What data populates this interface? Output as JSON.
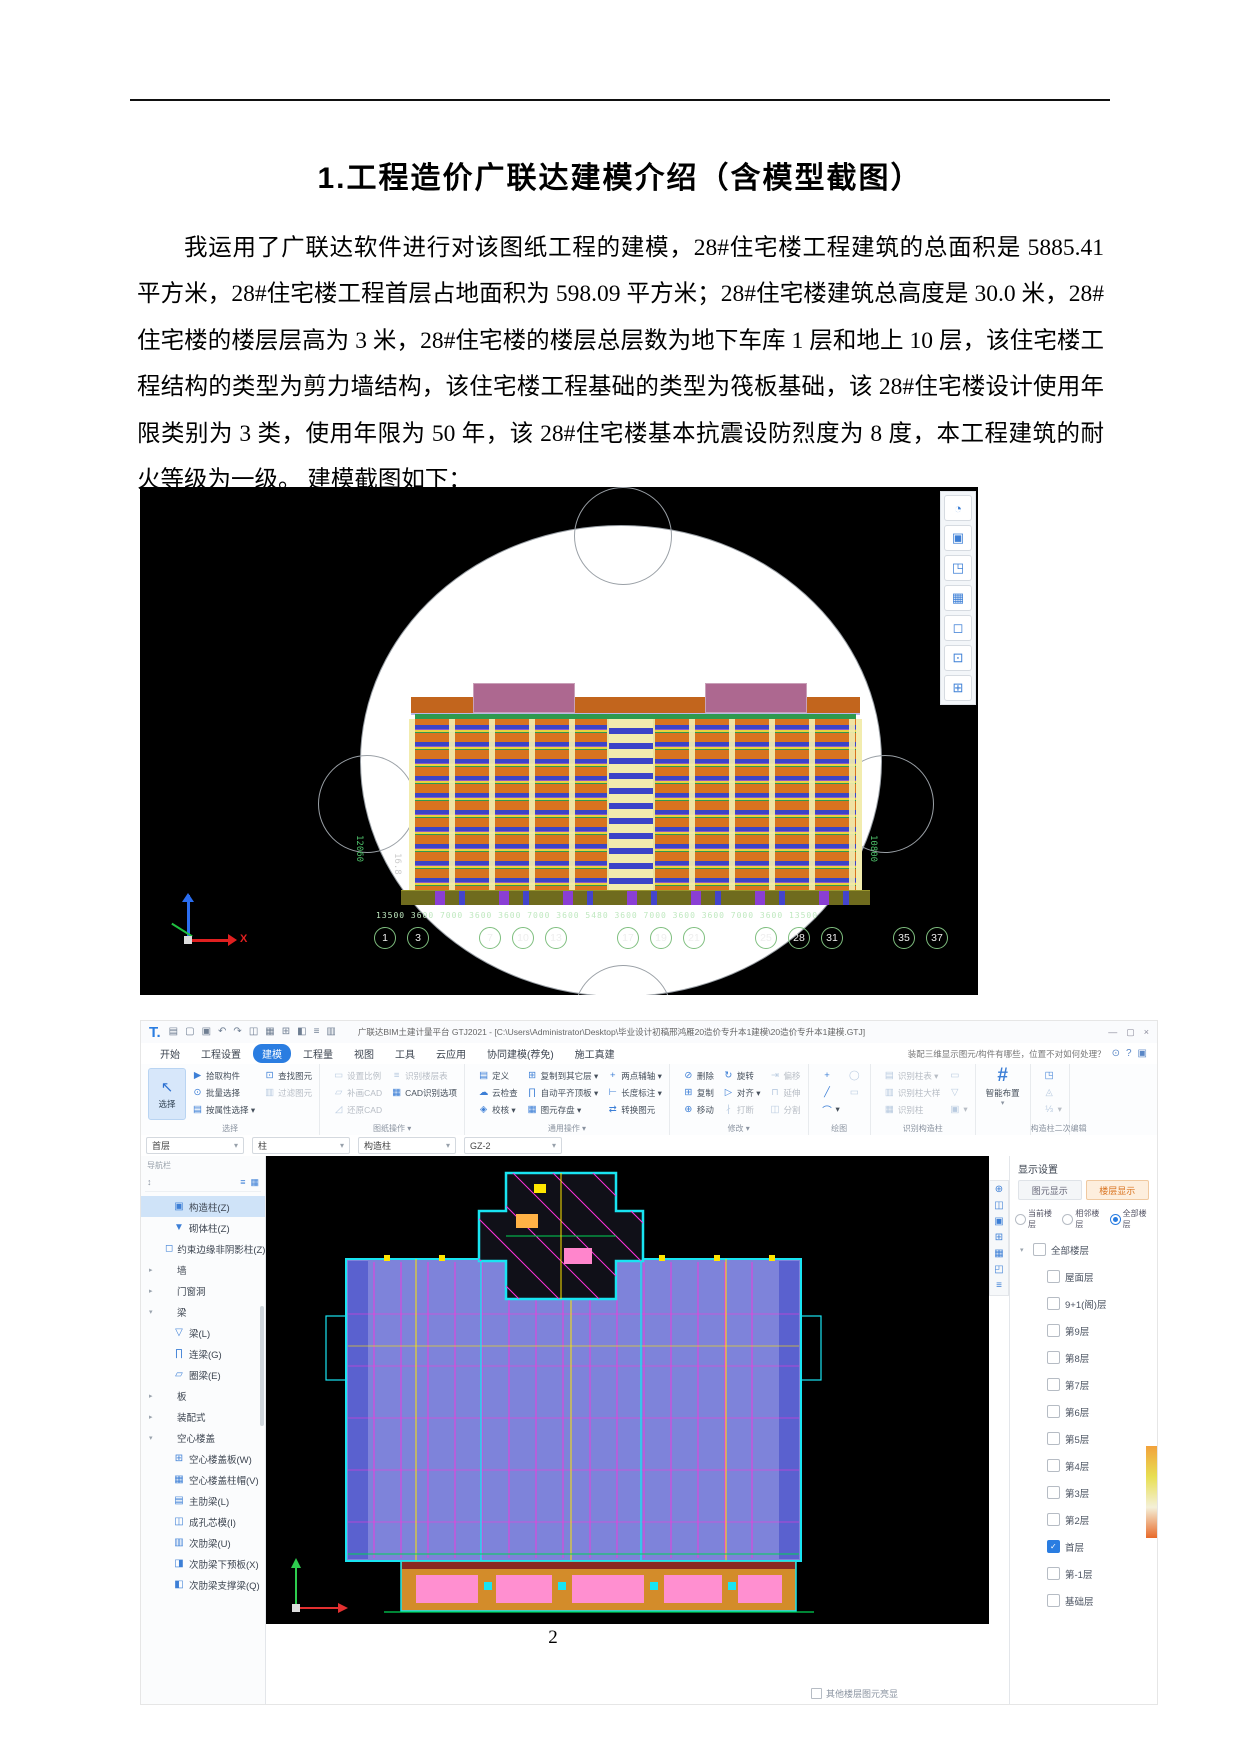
{
  "page": {
    "number": "2"
  },
  "doc": {
    "title": "1.工程造价广联达建模介绍（含模型截图）",
    "paragraph": "我运用了广联达软件进行对该图纸工程的建模，28#住宅楼工程建筑的总面积是 5885.41 平方米，28#住宅楼工程首层占地面积为 598.09 平方米；28#住宅楼建筑总高度是 30.0 米，28#住宅楼的楼层层高为 3 米，28#住宅楼的楼层总层数为地下车库 1 层和地上 10 层，该住宅楼工程结构的类型为剪力墙结构，该住宅楼工程基础的类型为筏板基础，该 28#住宅楼设计使用年限类别为 3 类，使用年限为 50 年，该 28#住宅楼基本抗震设防烈度为 8 度，本工程建筑的耐火等级为一级。 建模截图如下："
  },
  "model3d": {
    "dim_string": "13500 3600 7000 3600 3600 7000 3600 5480 3600 7000 3600 3600 7000 3600 13500",
    "left_dim": "12060",
    "left_dim2": "16.8",
    "right_dim": "10800",
    "axis_x": "X",
    "bubbles": [
      {
        "label": "1"
      },
      {
        "label": "3"
      },
      {
        "cls": "sp"
      },
      {
        "label": "7"
      },
      {
        "label": "10"
      },
      {
        "label": "13"
      },
      {
        "cls": "sp"
      },
      {
        "label": "17"
      },
      {
        "label": "19"
      },
      {
        "label": "21"
      },
      {
        "cls": "sp"
      },
      {
        "label": "25"
      },
      {
        "label": "28"
      },
      {
        "label": "31"
      },
      {
        "cls": "sp"
      },
      {
        "label": "35"
      },
      {
        "label": "37"
      }
    ],
    "tools": [
      {
        "g": "◔"
      },
      {
        "g": "▣"
      },
      {
        "g": "◳"
      },
      {
        "g": "▦"
      },
      {
        "g": "◻"
      },
      {
        "g": "⊡"
      },
      {
        "g": "⊞"
      }
    ]
  },
  "app": {
    "titlebar": {
      "logo": "T.",
      "quick_icons": [
        {
          "g": "▤"
        },
        {
          "g": "▢"
        },
        {
          "g": "▣"
        },
        {
          "g": "↶"
        },
        {
          "g": "↷"
        },
        {
          "g": "◫"
        },
        {
          "g": "▦"
        },
        {
          "g": "⊞"
        },
        {
          "g": "◧"
        },
        {
          "g": "≡"
        },
        {
          "g": "▥"
        }
      ],
      "title": "广联达BIM土建计量平台 GTJ2021 - [C:\\Users\\Administrator\\Desktop\\毕业设计初稿邢鸿雁20造价专升本1建模\\20造价专升本1建模.GTJ]",
      "window_controls": [
        {
          "g": "—"
        },
        {
          "g": "▢"
        },
        {
          "g": "×"
        }
      ]
    },
    "menubar": {
      "menus": [
        {
          "label": "开始"
        },
        {
          "label": "工程设置"
        },
        {
          "label": "建模",
          "cls": "active"
        },
        {
          "label": "工程量"
        },
        {
          "label": "视图"
        },
        {
          "label": "工具"
        },
        {
          "label": "云应用"
        },
        {
          "label": "协同建模(荐免)"
        },
        {
          "label": "施工真建"
        }
      ],
      "helper": "装配三维显示图元/构件有哪些，位置不对如何处理？",
      "helper_icons": [
        {
          "g": "⊙"
        },
        {
          "g": "?"
        },
        {
          "g": "▣"
        }
      ]
    },
    "ribbon": {
      "select_big": {
        "icon": "↖",
        "label": "选择"
      },
      "g1": {
        "label": "选择",
        "items": [
          {
            "ic": "▶",
            "label": "拾取构件"
          },
          {
            "ic": "⊡",
            "label": "查找图元"
          },
          {
            "ic": "⊙",
            "label": "批量选择"
          },
          {
            "ic": "▥",
            "label": "过滤图元",
            "cls": "gray"
          },
          {
            "ic": "▤",
            "label": "按属性选择 ▾"
          },
          {
            "label": "",
            "cls": "blank"
          }
        ]
      },
      "g2": {
        "label": "图纸操作 ▾",
        "items": [
          {
            "ic": "▭",
            "label": "设置比例",
            "cls": "gray"
          },
          {
            "ic": "≡",
            "label": "识别楼层表",
            "cls": "gray"
          },
          {
            "ic": "▱",
            "label": "补画CAD",
            "cls": "gray"
          },
          {
            "ic": "▦",
            "label": "CAD识别选项"
          },
          {
            "ic": "◿",
            "label": "还原CAD",
            "cls": "gray"
          },
          {
            "label": "",
            "cls": "blank"
          }
        ]
      },
      "g3": {
        "label": "通用操作 ▾",
        "items": [
          {
            "ic": "▤",
            "label": "定义"
          },
          {
            "ic": "⊞",
            "label": "复制到其它层 ▾"
          },
          {
            "ic": "+",
            "label": "两点辅轴 ▾"
          },
          {
            "ic": "☁",
            "label": "云检查"
          },
          {
            "ic": "∏",
            "label": "自动平齐顶板 ▾"
          },
          {
            "ic": "⊢",
            "label": "长度标注 ▾"
          },
          {
            "ic": "◈",
            "label": "校核 ▾"
          },
          {
            "ic": "▦",
            "label": "图元存盘 ▾"
          },
          {
            "ic": "⇄",
            "label": "转换图元"
          }
        ]
      },
      "g4": {
        "label": "修改 ▾",
        "items": [
          {
            "ic": "⊘",
            "label": "删除"
          },
          {
            "ic": "↻",
            "label": "旋转"
          },
          {
            "ic": "⇥",
            "label": "偏移",
            "cls": "gray"
          },
          {
            "ic": "⊞",
            "label": "复制"
          },
          {
            "ic": "▷",
            "label": "对齐 ▾"
          },
          {
            "ic": "⊓",
            "label": "延伸",
            "cls": "gray"
          },
          {
            "ic": "⊕",
            "label": "移动"
          },
          {
            "ic": "∤",
            "label": "打断",
            "cls": "gray"
          },
          {
            "ic": "◫",
            "label": "分割",
            "cls": "gray"
          }
        ]
      },
      "g5": {
        "label": "绘图",
        "items": [
          {
            "ic": "+",
            "label": ""
          },
          {
            "ic": "◯",
            "label": "",
            "cls": "gray"
          },
          {
            "ic": "╱",
            "label": ""
          },
          {
            "ic": "▭",
            "label": "",
            "cls": "gray"
          },
          {
            "ic": "⌒",
            "label": "▾"
          },
          {
            "label": "",
            "cls": "blank"
          }
        ]
      },
      "g6": {
        "label": "识别构造柱",
        "items": [
          {
            "ic": "▤",
            "label": "识别柱表 ▾",
            "cls": "gray"
          },
          {
            "ic": "▭",
            "label": "",
            "cls": "gray"
          },
          {
            "ic": "▥",
            "label": "识别柱大样",
            "cls": "gray"
          },
          {
            "ic": "▽",
            "label": "",
            "cls": "gray"
          },
          {
            "ic": "▦",
            "label": "识别柱",
            "cls": "gray"
          },
          {
            "ic": "▣",
            "label": "▾",
            "cls": "gray"
          }
        ]
      },
      "g7": {
        "icon": "#",
        "label": "智能布置",
        "arrow": "▾"
      },
      "g8": {
        "label": "构造柱二次编辑",
        "items": [
          {
            "ic": "◳",
            "label": ""
          },
          {
            "ic": "◬",
            "label": "",
            "cls": "gray"
          },
          {
            "ic": "⅓",
            "label": "▾",
            "cls": "gray"
          }
        ]
      }
    },
    "context": {
      "dropdowns": [
        {
          "label": "首层"
        },
        {
          "label": "柱"
        },
        {
          "label": "构造柱"
        },
        {
          "label": "GZ-2"
        }
      ]
    },
    "nav": {
      "header": "导航栏",
      "search_icon": "↕",
      "view_icons": [
        {
          "g": "≡"
        },
        {
          "g": "▦"
        }
      ],
      "items": [
        {
          "ic": "▣",
          "label": "构造柱(Z)",
          "cls": "sel",
          "level": 1
        },
        {
          "ic": "▼",
          "label": "砌体柱(Z)",
          "level": 1
        },
        {
          "ic": "◻",
          "label": "约束边缘非阴影柱(Z)",
          "level": 1
        },
        {
          "tw": "▸",
          "label": "墙",
          "level": 0
        },
        {
          "tw": "▸",
          "label": "门窗洞",
          "level": 0
        },
        {
          "tw": "▾",
          "label": "梁",
          "level": 0
        },
        {
          "ic": "▽",
          "label": "梁(L)",
          "level": 1
        },
        {
          "ic": "∏",
          "label": "连梁(G)",
          "level": 1
        },
        {
          "ic": "▱",
          "label": "圈梁(E)",
          "level": 1
        },
        {
          "tw": "▸",
          "label": "板",
          "level": 0
        },
        {
          "tw": "▸",
          "label": "装配式",
          "level": 0
        },
        {
          "tw": "▾",
          "label": "空心楼盖",
          "level": 0
        },
        {
          "ic": "⊞",
          "label": "空心楼盖板(W)",
          "level": 1
        },
        {
          "ic": "▦",
          "label": "空心楼盖柱帽(V)",
          "level": 1
        },
        {
          "ic": "▤",
          "label": "主肋梁(L)",
          "level": 1
        },
        {
          "ic": "◫",
          "label": "成孔芯模(I)",
          "level": 1
        },
        {
          "ic": "▥",
          "label": "次肋梁(U)",
          "level": 1
        },
        {
          "ic": "◨",
          "label": "次肋梁下预板(X)",
          "level": 1
        },
        {
          "ic": "◧",
          "label": "次肋梁支撑梁(Q)",
          "level": 1
        }
      ]
    },
    "canvas_tools": [
      {
        "g": "⊕"
      },
      {
        "g": "◫"
      },
      {
        "g": "▣"
      },
      {
        "g": "⊞"
      },
      {
        "g": "▦"
      },
      {
        "g": "◰"
      },
      {
        "g": "≡"
      }
    ],
    "display": {
      "header": "显示设置",
      "tabs": [
        {
          "label": "图元显示"
        },
        {
          "label": "楼层显示",
          "cls": "active"
        }
      ],
      "radios": [
        {
          "label": "当前楼层"
        },
        {
          "label": "相邻楼层"
        },
        {
          "label": "全部楼层",
          "cls": "sel"
        }
      ],
      "floors": [
        {
          "tw": "▾",
          "label": "全部楼层",
          "level": 0
        },
        {
          "label": "屋面层",
          "level": 1
        },
        {
          "label": "9+1(阁)层",
          "level": 1
        },
        {
          "label": "第9层",
          "level": 1
        },
        {
          "label": "第8层",
          "level": 1
        },
        {
          "label": "第7层",
          "level": 1
        },
        {
          "label": "第6层",
          "level": 1
        },
        {
          "label": "第5层",
          "level": 1
        },
        {
          "label": "第4层",
          "level": 1
        },
        {
          "label": "第3层",
          "level": 1
        },
        {
          "label": "第2层",
          "level": 1
        },
        {
          "label": "首层",
          "cls": "chk",
          "level": 1
        },
        {
          "label": "第-1层",
          "level": 1
        },
        {
          "label": "基础层",
          "level": 1
        }
      ],
      "bottom_option": "其他楼层图元亮显"
    }
  }
}
